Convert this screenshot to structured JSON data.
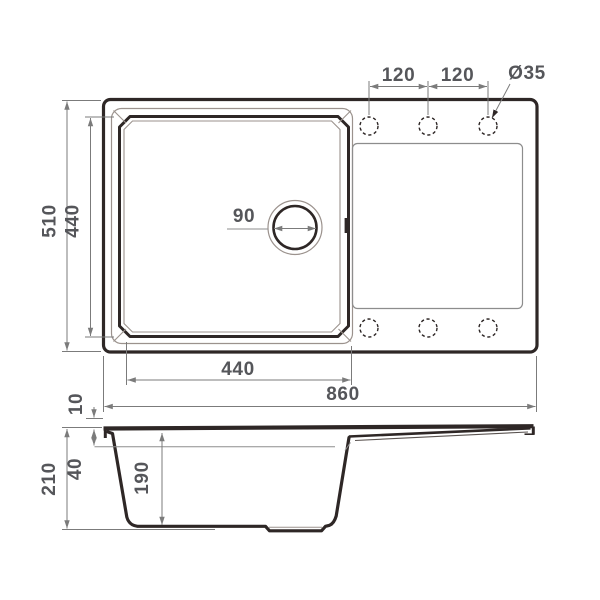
{
  "page": {
    "background": "#ffffff"
  },
  "drawing": {
    "type": "kitchen-sink-technical-drawing",
    "views": {
      "top": {
        "dimensions": {
          "hole_pitch_left": "120",
          "hole_pitch_right": "120",
          "hole_diameter": "Ø35",
          "overall_width": "510",
          "bowl_inner_width": "440",
          "drain_diameter": "90",
          "bowl_inner_length": "440",
          "overall_length": "860"
        },
        "faucet_holes_top_count": 3,
        "faucet_holes_bottom_count": 3
      },
      "side": {
        "dimensions": {
          "rim_height": "10",
          "overall_depth": "210",
          "ledge_depth": "40",
          "bowl_depth": "190"
        }
      }
    },
    "colors": {
      "outline": "#2e2726",
      "thin_line": "#9b928d",
      "dimension_line": "#7b7b7b",
      "dimension_text": "#55565a",
      "background": "#ffffff"
    }
  }
}
